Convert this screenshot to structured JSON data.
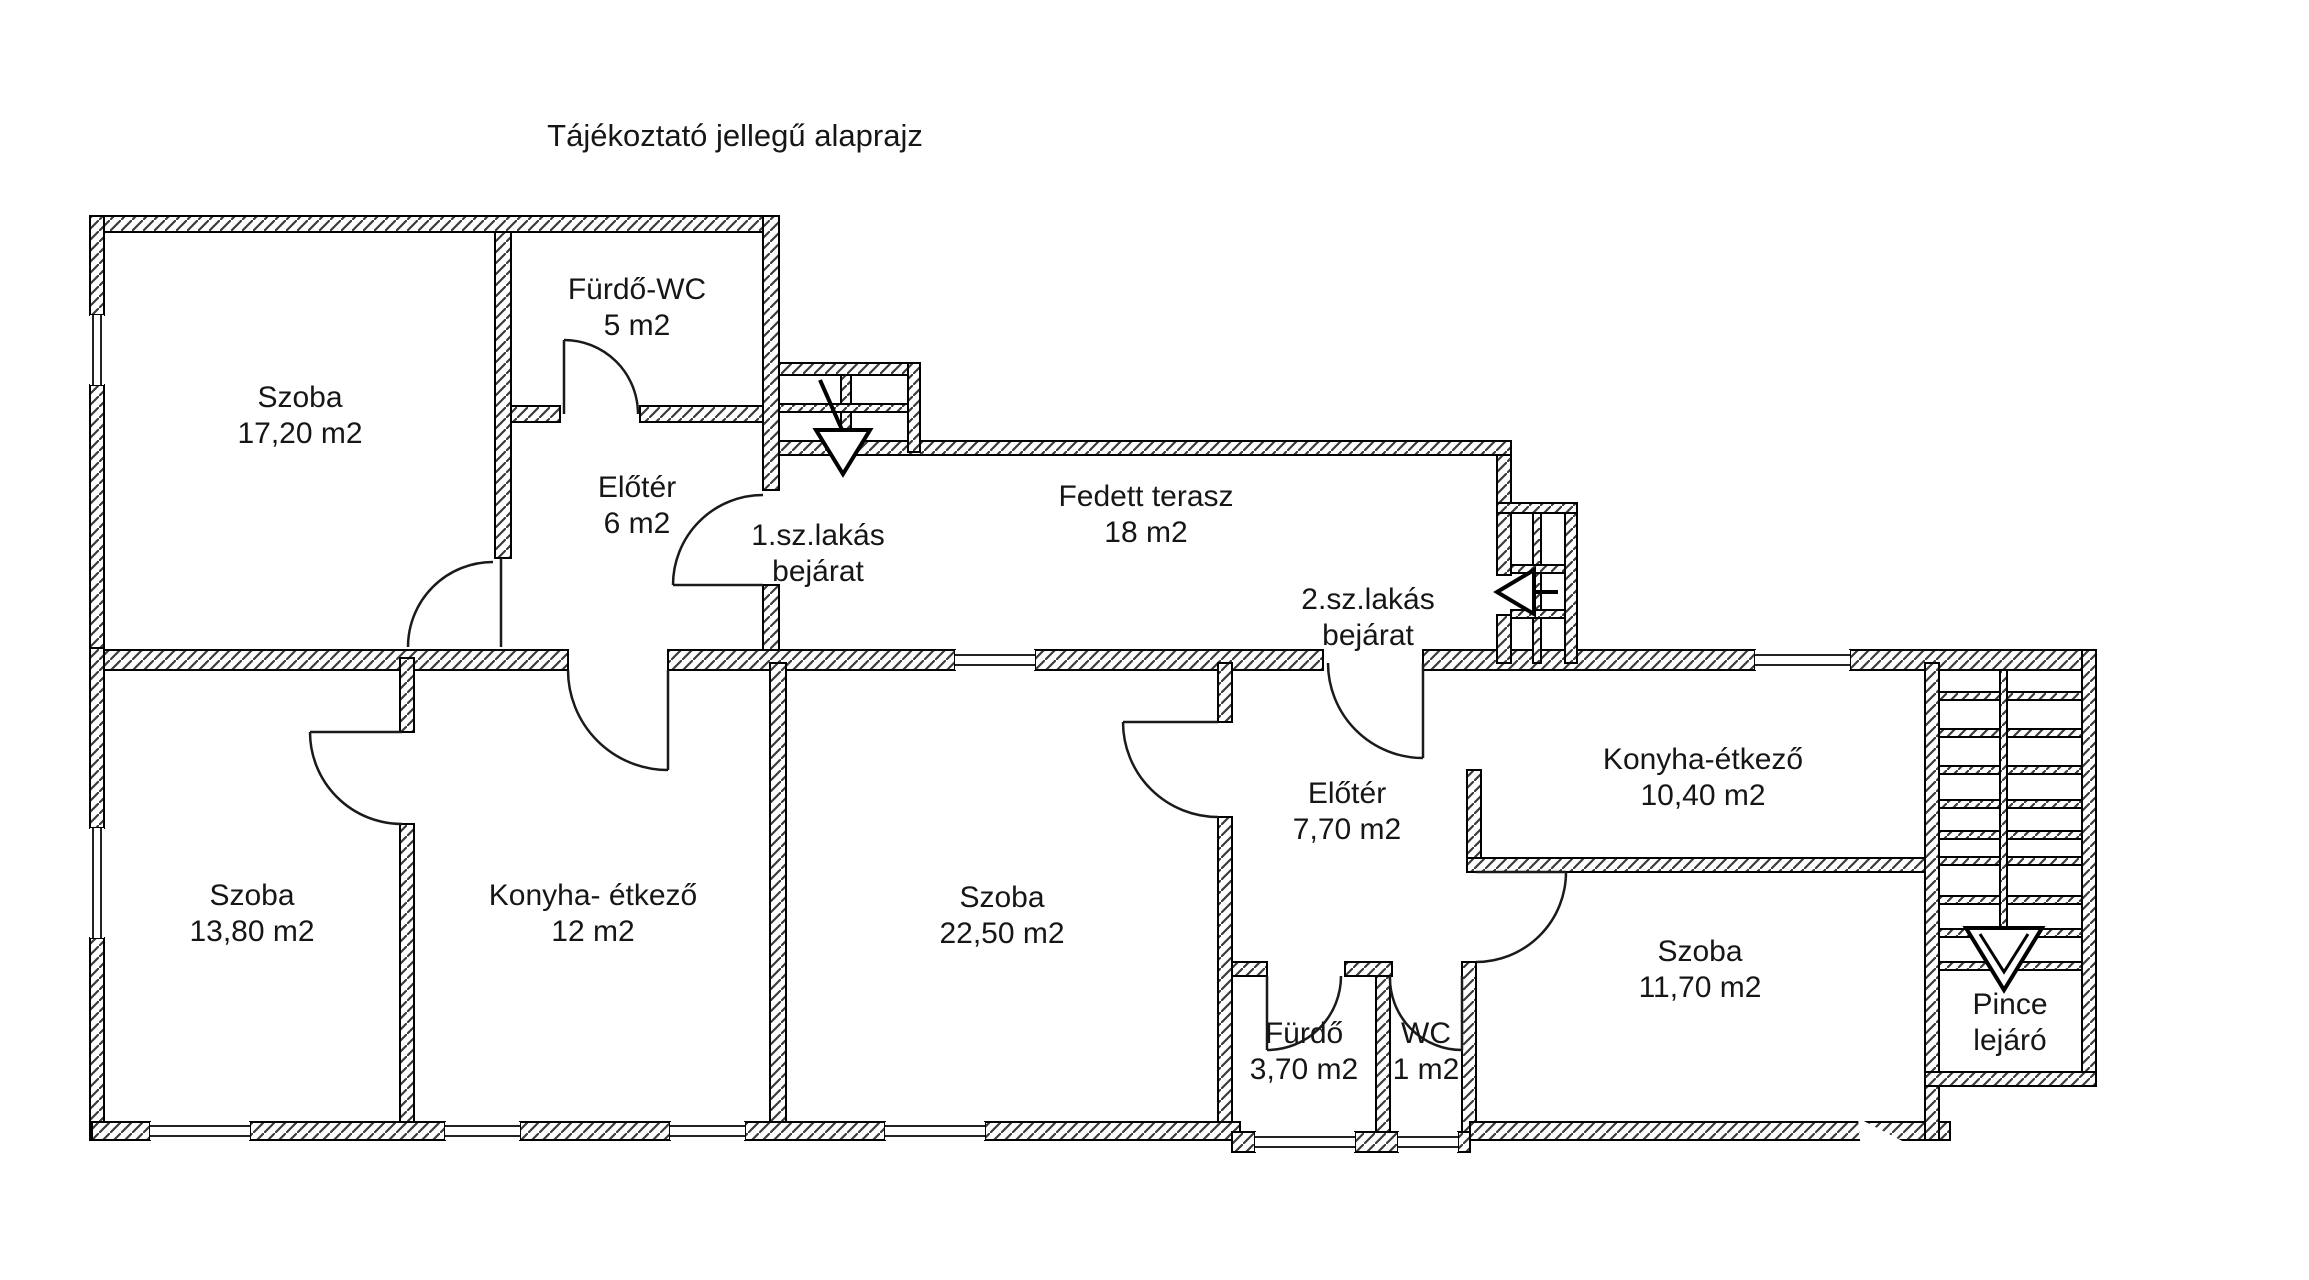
{
  "title": "Tájékoztató jellegű alaprajz",
  "plan": {
    "apartment1": {
      "entrance": {
        "line1": "1.sz.lakás",
        "line2": "bejárat"
      },
      "rooms": {
        "szoba_nagy": {
          "name": "Szoba",
          "area": "17,20 m2"
        },
        "furdo_wc": {
          "name": "Fürdő-WC",
          "area": "5 m2"
        },
        "eloter": {
          "name": "Előtér",
          "area": "6 m2"
        },
        "szoba_kis": {
          "name": "Szoba",
          "area": "13,80 m2"
        },
        "konyha": {
          "name": "Konyha- étkező",
          "area": "12 m2"
        }
      }
    },
    "apartment2": {
      "entrance": {
        "line1": "2.sz.lakás",
        "line2": "bejárat"
      },
      "rooms": {
        "szoba_nagy": {
          "name": "Szoba",
          "area": "22,50 m2"
        },
        "eloter": {
          "name": "Előtér",
          "area": "7,70 m2"
        },
        "konyha": {
          "name": "Konyha-étkező",
          "area": "10,40 m2"
        },
        "szoba_kis": {
          "name": "Szoba",
          "area": "11,70 m2"
        },
        "furdo": {
          "name": "Fürdő",
          "area": "3,70 m2"
        },
        "wc": {
          "name": "WC",
          "area": "1 m2"
        }
      }
    },
    "shared": {
      "terasz": {
        "name": "Fedett terasz",
        "area": "18 m2"
      },
      "pince": {
        "line1": "Pince",
        "line2": "lejáró"
      }
    }
  }
}
